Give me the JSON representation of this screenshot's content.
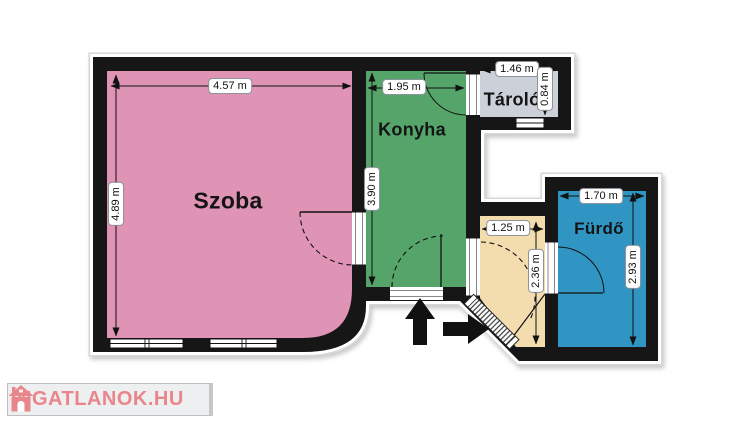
{
  "plan": {
    "colors": {
      "wall": "#161616",
      "background": "#ffffff",
      "outline_halo": "#d7d7d7",
      "dimension_text": "#111111"
    },
    "rooms": {
      "szoba": {
        "label": "Szoba",
        "color": "#df93b5",
        "width": "4.57 m",
        "height": "4.89 m"
      },
      "konyha": {
        "label": "Konyha",
        "color": "#55a56a",
        "width": "1.95 m",
        "height": "3.90 m"
      },
      "tarolo": {
        "label": "Tároló",
        "color": "#ccd1d9",
        "width": "1.46 m",
        "height": "0.84 m"
      },
      "eloter": {
        "color": "#f3ddae",
        "width": "1.25 m",
        "height": "2.36 m"
      },
      "furdo": {
        "label": "Fürdő",
        "color": "#3095c2",
        "width": "1.70 m",
        "height": "2.93 m"
      }
    }
  },
  "watermark": {
    "text": "INGATLANOK.HU",
    "color": "#e9868c"
  }
}
